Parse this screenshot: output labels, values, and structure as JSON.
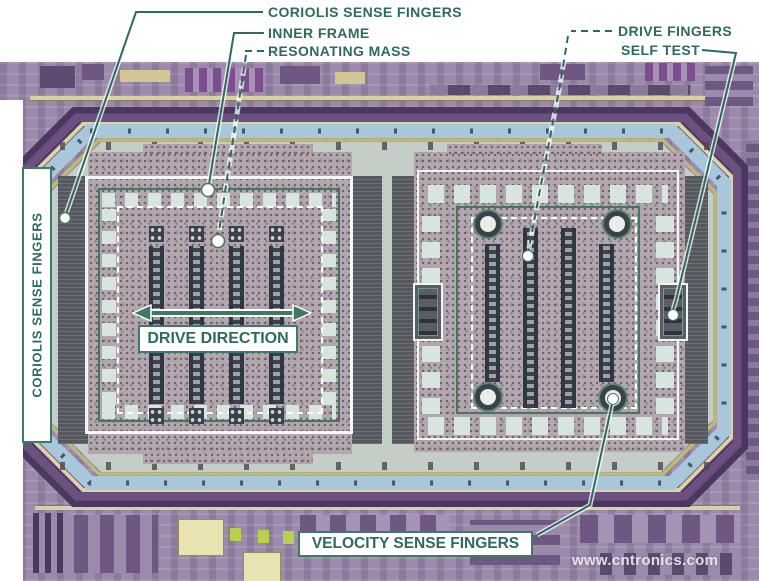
{
  "figure": {
    "annotations": {
      "coriolis_top": "CORIOLIS SENSE FINGERS",
      "inner_frame": "INNER FRAME",
      "resonating_mass": "RESONATING MASS",
      "drive_fingers": "DRIVE FINGERS",
      "self_test": "SELF TEST",
      "coriolis_side": "CORIOLIS SENSE FINGERS",
      "drive_direction": "DRIVE DIRECTION",
      "velocity_sense": "VELOCITY SENSE FINGERS"
    },
    "watermark": "www.cntronics.com",
    "colors": {
      "annotation_text": "#2e6b5c",
      "annotation_line": "#2e6b5c",
      "box_border": "#3f7a68",
      "die_base_purple": "#9c8aac",
      "seal_ring_blue": "#a9c7da",
      "cavity_green": "#c4cec6",
      "mass_speckle": "#b3a7af",
      "finger_band_dark": "#55585f"
    }
  }
}
